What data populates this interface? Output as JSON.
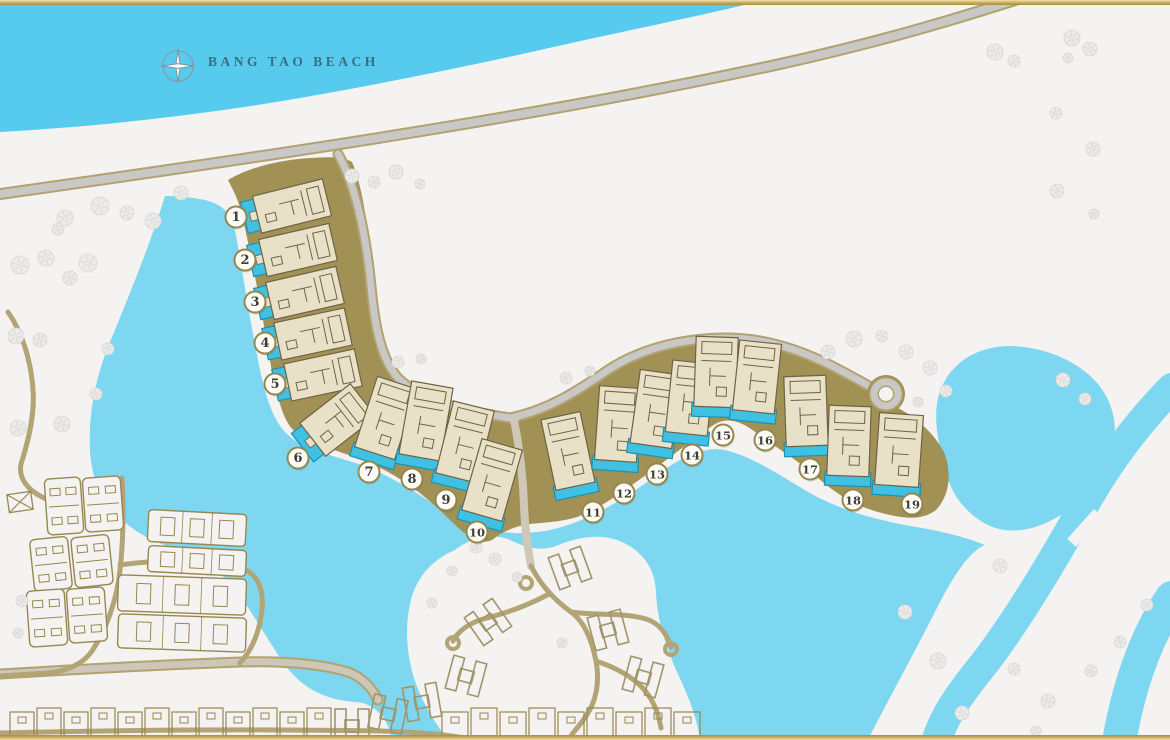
{
  "map": {
    "beach_label": "BANG TAO BEACH",
    "colors": {
      "sea": "#57CBEE",
      "lagoon": "#7ED7F0",
      "land": "#F4F3F1",
      "band": "#A29155",
      "villaFill": "#E9E0C8",
      "villaLine": "#6E6345",
      "pool": "#3EC1E2",
      "poolEdge": "#1B91B4",
      "roadGray": "#C9C8C6",
      "roadEdge": "#B2A26E",
      "pathTan": "#B3A476",
      "pathPale": "#CFC8B6",
      "streetFill": "#CCC7B8",
      "outline": "#97874F",
      "hOutline": "#A1946A",
      "tree": "#ECEBE9",
      "treeLine": "#D6D5D3",
      "circleFill": "#FDFCF7",
      "circleEdge": "#97874F",
      "number": "#3E3C33",
      "label": "#3E6B84",
      "compassRing": "#8A9BA6",
      "compassStar": "#FAFBFB",
      "compassEdge": "#7E909B"
    },
    "villas": [
      {
        "number": "1",
        "marker": {
          "x": 236,
          "y": 217
        },
        "building": {
          "x": 292,
          "y": 206,
          "w": 72,
          "h": 38,
          "rot": -14,
          "pool": "left"
        }
      },
      {
        "number": "2",
        "marker": {
          "x": 245,
          "y": 260
        },
        "building": {
          "x": 298,
          "y": 250,
          "w": 72,
          "h": 38,
          "rot": -13,
          "pool": "left"
        }
      },
      {
        "number": "3",
        "marker": {
          "x": 255,
          "y": 302
        },
        "building": {
          "x": 305,
          "y": 293,
          "w": 72,
          "h": 38,
          "rot": -13,
          "pool": "left"
        }
      },
      {
        "number": "4",
        "marker": {
          "x": 265,
          "y": 343
        },
        "building": {
          "x": 313,
          "y": 334,
          "w": 72,
          "h": 38,
          "rot": -12,
          "pool": "left"
        }
      },
      {
        "number": "5",
        "marker": {
          "x": 275,
          "y": 384
        },
        "building": {
          "x": 323,
          "y": 375,
          "w": 72,
          "h": 38,
          "rot": -12,
          "pool": "left"
        }
      },
      {
        "number": "6",
        "marker": {
          "x": 298,
          "y": 458
        },
        "building": {
          "x": 338,
          "y": 420,
          "w": 64,
          "h": 42,
          "rot": -38,
          "pool": "left"
        }
      },
      {
        "number": "7",
        "marker": {
          "x": 369,
          "y": 472
        },
        "building": {
          "x": 386,
          "y": 418,
          "w": 42,
          "h": 74,
          "rot": 18,
          "pool": "bottom"
        }
      },
      {
        "number": "8",
        "marker": {
          "x": 412,
          "y": 479
        },
        "building": {
          "x": 426,
          "y": 421,
          "w": 42,
          "h": 74,
          "rot": 10,
          "pool": "bottom"
        }
      },
      {
        "number": "9",
        "marker": {
          "x": 446,
          "y": 500
        },
        "building": {
          "x": 465,
          "y": 442,
          "w": 42,
          "h": 74,
          "rot": 14,
          "pool": "bottom"
        }
      },
      {
        "number": "10",
        "marker": {
          "x": 477,
          "y": 532
        },
        "building": {
          "x": 492,
          "y": 480,
          "w": 42,
          "h": 74,
          "rot": 16,
          "pool": "bottom"
        }
      },
      {
        "number": "11",
        "marker": {
          "x": 593,
          "y": 512
        },
        "building": {
          "x": 568,
          "y": 451,
          "w": 40,
          "h": 72,
          "rot": -12,
          "pool": "bottom"
        }
      },
      {
        "number": "12",
        "marker": {
          "x": 624,
          "y": 493
        },
        "building": {
          "x": 618,
          "y": 424,
          "w": 42,
          "h": 74,
          "rot": 4,
          "pool": "bottom"
        }
      },
      {
        "number": "13",
        "marker": {
          "x": 657,
          "y": 474
        },
        "building": {
          "x": 656,
          "y": 409,
          "w": 42,
          "h": 74,
          "rot": 8,
          "pool": "bottom"
        }
      },
      {
        "number": "14",
        "marker": {
          "x": 692,
          "y": 455
        },
        "building": {
          "x": 690,
          "y": 398,
          "w": 42,
          "h": 72,
          "rot": 6,
          "pool": "bottom"
        }
      },
      {
        "number": "15",
        "marker": {
          "x": 723,
          "y": 435
        },
        "building": {
          "x": 716,
          "y": 372,
          "w": 42,
          "h": 70,
          "rot": 2,
          "pool": "bottom"
        }
      },
      {
        "number": "16",
        "marker": {
          "x": 765,
          "y": 440
        },
        "building": {
          "x": 757,
          "y": 377,
          "w": 42,
          "h": 70,
          "rot": 6,
          "pool": "bottom"
        }
      },
      {
        "number": "17",
        "marker": {
          "x": 810,
          "y": 469
        },
        "building": {
          "x": 806,
          "y": 411,
          "w": 42,
          "h": 70,
          "rot": -2,
          "pool": "bottom"
        }
      },
      {
        "number": "18",
        "marker": {
          "x": 853,
          "y": 500
        },
        "building": {
          "x": 849,
          "y": 441,
          "w": 42,
          "h": 70,
          "rot": 2,
          "pool": "bottom"
        }
      },
      {
        "number": "19",
        "marker": {
          "x": 912,
          "y": 504
        },
        "building": {
          "x": 899,
          "y": 450,
          "w": 44,
          "h": 72,
          "rot": 4,
          "pool": "bottom"
        }
      }
    ],
    "geometry": {
      "sea": "M0,0 L765,0 C700,16 620,32 540,50 C460,68 380,84 300,98 C220,112 110,126 0,132 Z",
      "lagoon_main": "M165,196 C150,245 128,298 110,342 C96,376 88,412 90,452 C93,492 112,518 148,538 C175,550 205,562 225,578 C245,598 262,632 285,665 C305,692 330,700 355,702 C375,703 388,718 392,740 L868,740 C888,700 915,652 940,602 C958,568 972,550 985,545 C960,535 935,530 905,525 C870,518 840,510 808,492 C778,474 755,458 725,450 C700,446 680,458 650,480 C615,505 585,522 550,530 C515,537 480,532 450,515 C425,498 395,478 365,466 C335,456 305,450 288,435 C272,420 265,395 258,360 C250,320 243,275 236,235 C232,215 225,205 205,200 C190,197 175,196 165,196 Z",
      "lagoon_kidney": "M938,398 C946,366 974,346 1010,346 C1046,347 1082,362 1101,388 C1116,409 1119,434 1109,460 C1098,488 1076,508 1050,521 C1028,532 1004,534 986,524 C966,513 952,496 946,472 C939,447 933,421 938,398 Z",
      "canal_a": "M1172,388 C1140,420 1108,462 1083,507 C1058,552 1018,620 983,665 C958,696 944,716 936,742",
      "canal_b": "M1172,598 C1150,630 1130,678 1119,742",
      "canal_crossing": {
        "x": 1085,
        "y": 528,
        "w": 40,
        "h": 12,
        "rot": -48
      },
      "peninsula": "M455,550 C470,538 492,532 510,540 C525,547 540,552 556,546 C575,538 600,532 622,542 C642,551 655,568 656,592 C657,620 666,648 678,674 C690,700 698,722 700,740 L448,740 C436,724 424,706 416,684 C406,656 404,624 412,596 C420,572 436,558 455,550 Z",
      "band": "M228,180 C248,168 278,160 310,158 C328,157 342,156 352,162 C362,185 368,225 372,268 C375,305 378,338 388,362 C398,385 420,398 448,406 C472,412 492,416 510,418 C545,410 572,394 605,372 C640,350 680,340 722,338 C762,337 800,350 832,366 C856,378 874,390 890,404 C912,414 932,430 944,452 C952,472 950,495 936,510 C920,522 900,518 878,512 C856,506 836,494 818,478 C800,462 780,450 758,434 C740,420 726,416 712,426 C692,440 672,456 650,472 C628,488 606,504 585,514 C566,522 548,522 530,524 C515,526 502,532 492,540 C478,546 464,534 448,518 C430,500 410,484 388,472 C366,460 340,452 316,444 C298,438 288,428 282,410 C274,388 270,360 264,326 C258,290 250,250 242,215 C238,198 232,188 228,180 Z",
      "road_main": "M0,194 C300,152 560,112 780,64 C880,42 960,18 1040,-8",
      "road_branch": "M338,154 C356,186 366,236 371,286 C375,330 382,360 398,378 C418,398 456,410 510,418 C548,410 576,392 608,370 C642,348 682,339 722,338 C762,337 800,350 830,365 C852,376 872,388 884,394",
      "roundabout": {
        "x": 886,
        "y": 394
      },
      "path_descent": "M514,420 C520,450 523,475 524,505 C525,532 528,548 531,566",
      "peninsula_roads": [
        "M531,566 C541,586 556,601 571,612 C585,622 592,641 596,661 C600,682 596,702 586,716 C579,727 571,734 567,742",
        "M571,612 C600,616 622,612 646,619 C659,623 667,634 671,647",
        "M596,661 C620,669 639,681 649,696 C655,705 659,716 661,728",
        "M549,594 C527,606 506,613 487,618 C470,622 458,631 453,641"
      ],
      "culdesacs": [
        [
          526,
          583
        ],
        [
          453,
          643
        ],
        [
          671,
          649
        ]
      ],
      "roads_tan": [
        "M8,312 C22,332 31,360 33,390 C35,415 28,442 21,464 C18,479 29,491 44,498 C53,502 61,508 66,516",
        "M122,478 C124,510 123,545 120,570 C117,600 106,630 92,651 C84,663 68,671 48,673 L0,676",
        "M120,565 C160,559 201,561 240,568 C257,572 264,589 262,609 C260,631 252,650 240,663",
        "M0,733 C120,730 260,729 380,731 C420,732 450,735 470,739"
      ],
      "road_street": "M0,674 C80,669 160,665 240,662 C280,661 318,663 348,672 C362,677 372,688 378,700",
      "condos": [
        [
          64,
          506,
          36,
          56,
          -4
        ],
        [
          103,
          504,
          38,
          54,
          -4
        ],
        [
          51,
          564,
          38,
          52,
          -6
        ],
        [
          92,
          561,
          38,
          50,
          -6
        ],
        [
          47,
          618,
          38,
          56,
          -4
        ],
        [
          87,
          615,
          38,
          54,
          -4
        ]
      ],
      "slabs": [
        [
          197,
          528,
          98,
          32,
          3
        ],
        [
          197,
          561,
          98,
          26,
          3
        ],
        [
          182,
          595,
          128,
          36,
          2
        ],
        [
          182,
          633,
          128,
          34,
          2
        ]
      ],
      "town_rows": [
        {
          "x": 10,
          "y": 712,
          "count": 12,
          "step": 27,
          "w": 24,
          "h": 42
        },
        {
          "x": 442,
          "y": 712,
          "count": 9,
          "step": 29,
          "w": 26,
          "h": 46
        }
      ],
      "h_villas": [
        [
          570,
          568,
          -20
        ],
        [
          488,
          622,
          -35
        ],
        [
          466,
          676,
          15
        ],
        [
          608,
          630,
          -15
        ],
        [
          643,
          677,
          15
        ],
        [
          422,
          702,
          -10
        ],
        [
          388,
          714,
          12
        ],
        [
          352,
          726,
          0
        ]
      ],
      "x_square": [
        20,
        502,
        -8
      ],
      "trees": [
        [
          65,
          218,
          8
        ],
        [
          100,
          206,
          9
        ],
        [
          127,
          213,
          7
        ],
        [
          153,
          221,
          8
        ],
        [
          181,
          193,
          7
        ],
        [
          58,
          229,
          6
        ],
        [
          20,
          265,
          9
        ],
        [
          46,
          258,
          8
        ],
        [
          88,
          263,
          9
        ],
        [
          70,
          278,
          7
        ],
        [
          16,
          336,
          8
        ],
        [
          40,
          340,
          7
        ],
        [
          108,
          349,
          6
        ],
        [
          62,
          424,
          8
        ],
        [
          18,
          428,
          8
        ],
        [
          96,
          394,
          6
        ],
        [
          352,
          176,
          7
        ],
        [
          374,
          182,
          6
        ],
        [
          396,
          172,
          7
        ],
        [
          420,
          184,
          5
        ],
        [
          398,
          362,
          6
        ],
        [
          421,
          359,
          5
        ],
        [
          566,
          378,
          6
        ],
        [
          590,
          371,
          5
        ],
        [
          828,
          352,
          7
        ],
        [
          854,
          339,
          8
        ],
        [
          882,
          336,
          6
        ],
        [
          906,
          352,
          7
        ],
        [
          930,
          368,
          7
        ],
        [
          946,
          391,
          6
        ],
        [
          918,
          402,
          5
        ],
        [
          995,
          52,
          8
        ],
        [
          1014,
          61,
          6
        ],
        [
          1072,
          38,
          8
        ],
        [
          1090,
          49,
          7
        ],
        [
          1068,
          58,
          5
        ],
        [
          1056,
          113,
          6
        ],
        [
          1093,
          149,
          7
        ],
        [
          1057,
          191,
          7
        ],
        [
          1094,
          214,
          5
        ],
        [
          1063,
          380,
          7
        ],
        [
          1085,
          399,
          6
        ],
        [
          1000,
          566,
          7
        ],
        [
          905,
          612,
          7
        ],
        [
          938,
          661,
          8
        ],
        [
          1014,
          669,
          6
        ],
        [
          962,
          713,
          7
        ],
        [
          1048,
          701,
          7
        ],
        [
          1091,
          671,
          6
        ],
        [
          1120,
          642,
          6
        ],
        [
          1147,
          605,
          6
        ],
        [
          1036,
          731,
          5
        ],
        [
          476,
          547,
          6
        ],
        [
          495,
          559,
          6
        ],
        [
          517,
          577,
          5
        ],
        [
          452,
          571,
          5
        ],
        [
          562,
          643,
          5
        ],
        [
          432,
          603,
          5
        ],
        [
          22,
          601,
          6
        ],
        [
          18,
          633,
          5
        ]
      ]
    }
  }
}
